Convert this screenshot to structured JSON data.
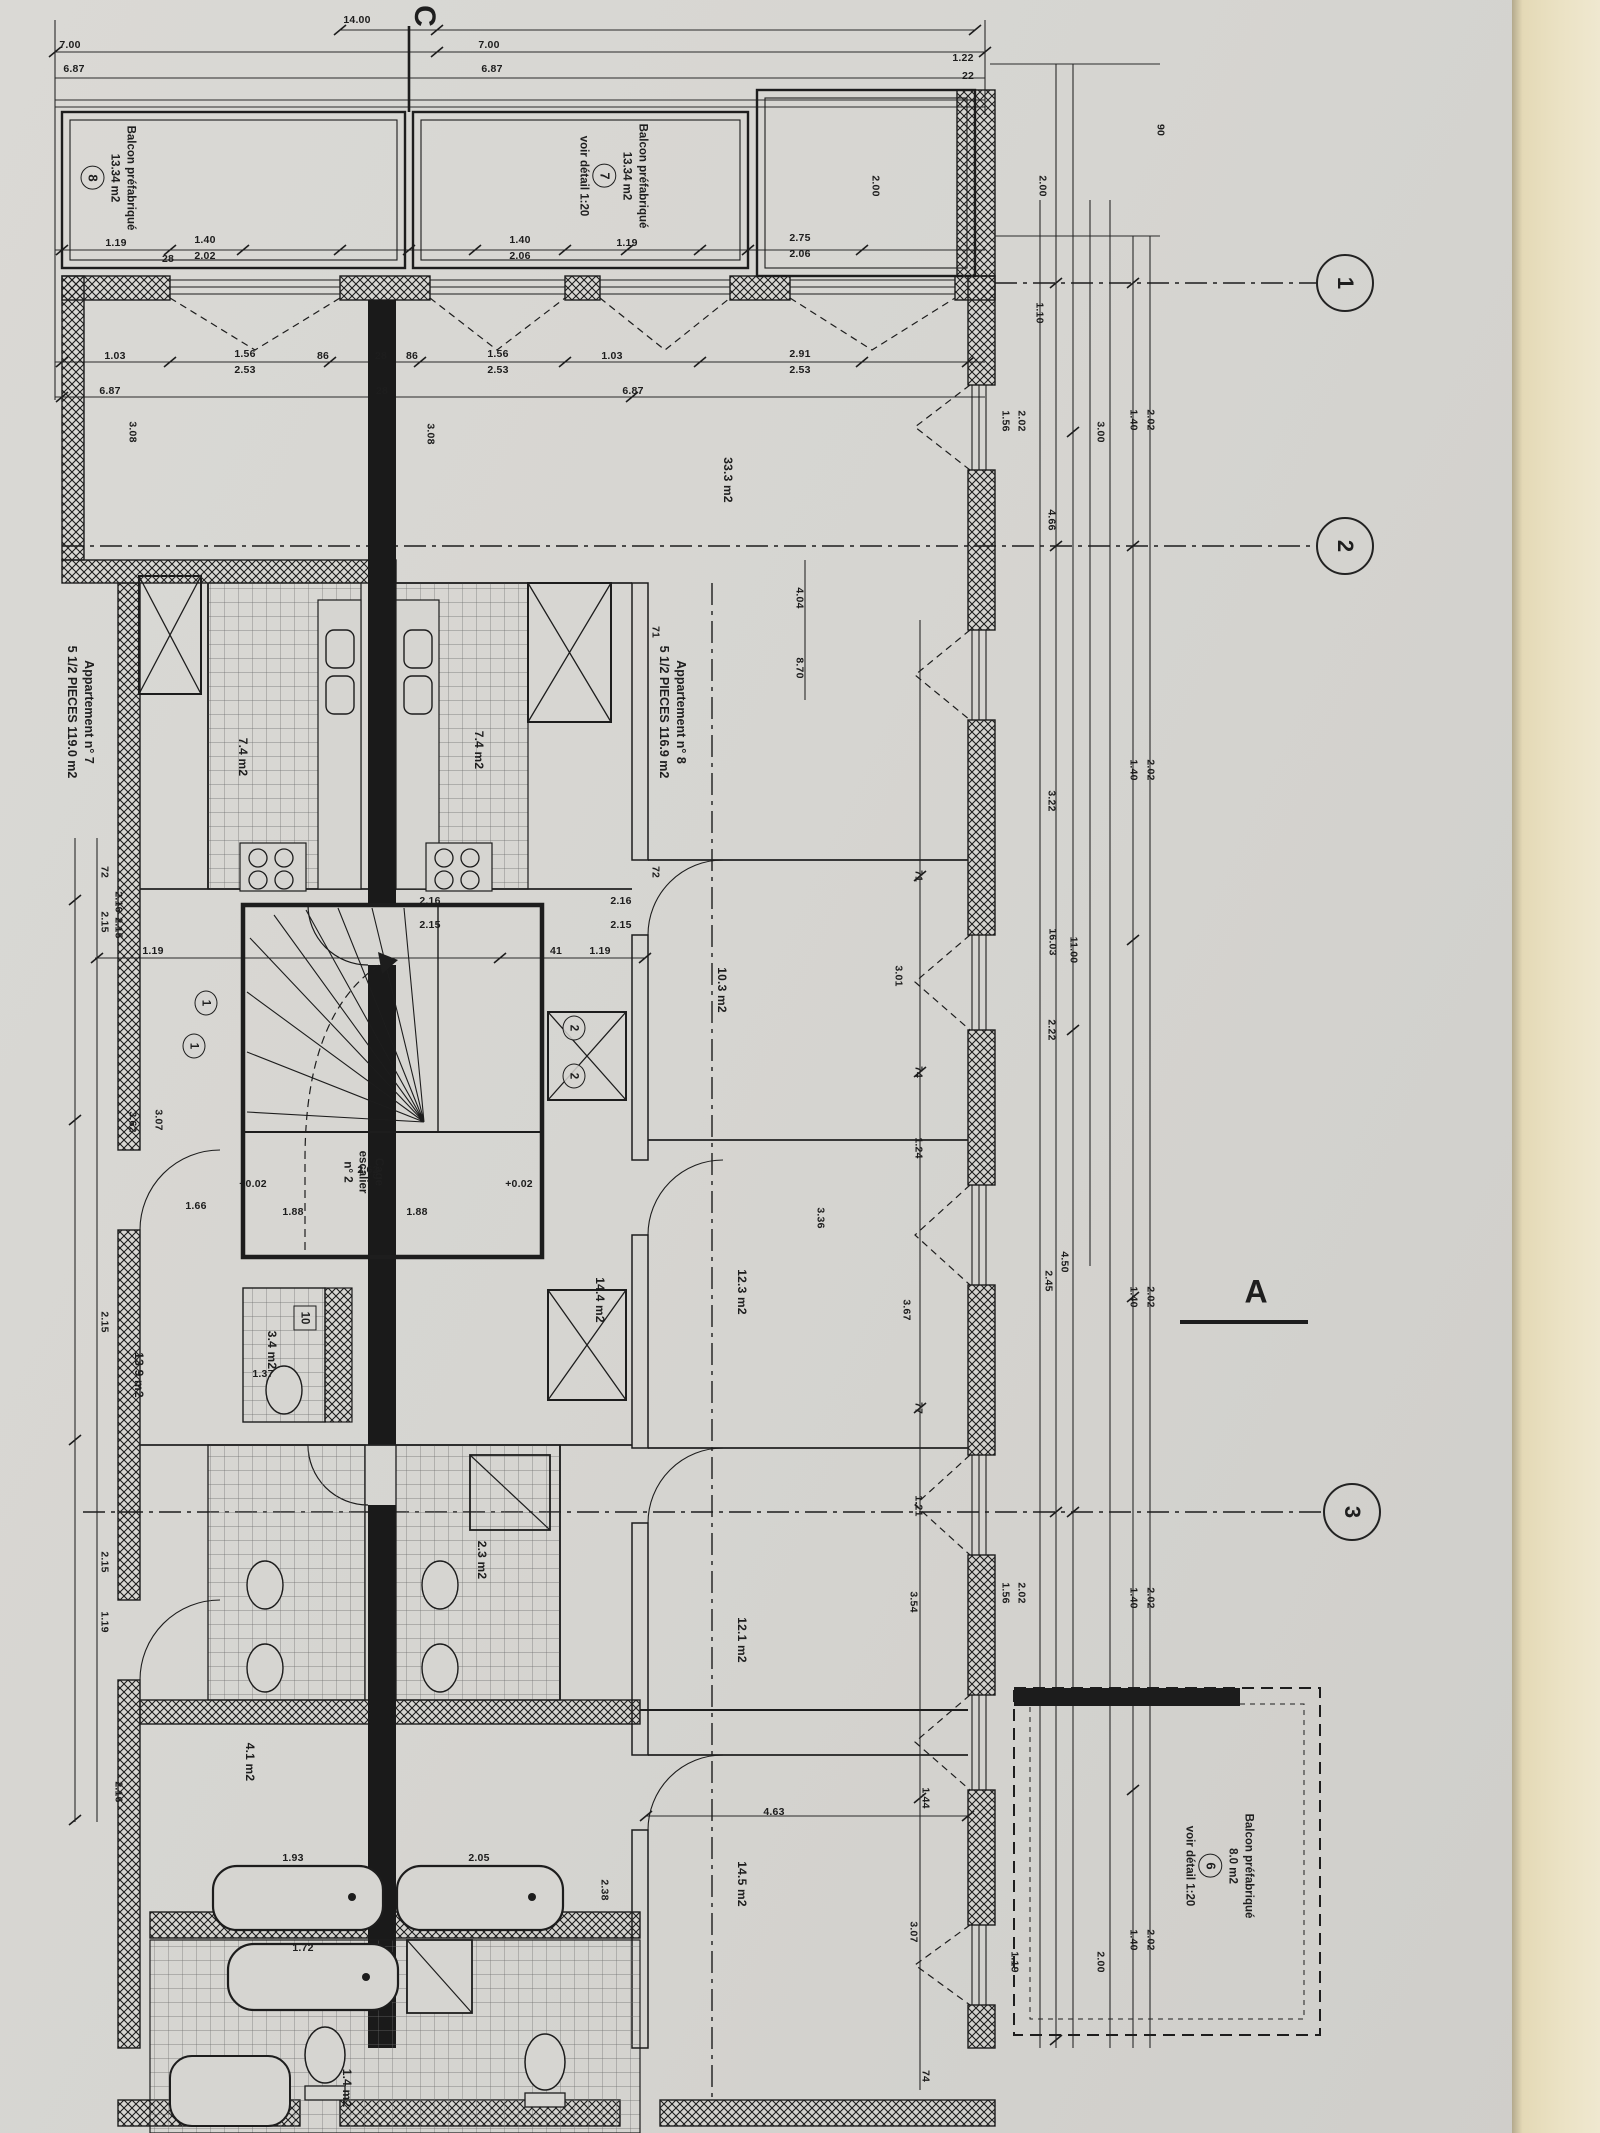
{
  "colors": {
    "paper": "#d6d5d1",
    "ink": "#1e1e1e",
    "cream_strip": "#ebe2c4"
  },
  "grid": {
    "c": "C",
    "section_a": "A",
    "bubbles": [
      "1",
      "2",
      "3"
    ]
  },
  "apartments": [
    {
      "line1": "Appartement n° 7",
      "line2": "5 1/2 PIECES 119.0 m2"
    },
    {
      "line1": "Appartement n° 8",
      "line2": "5 1/2 PIECES 116.9 m2"
    }
  ],
  "balconies": [
    {
      "name": "Balcon préfabriqué",
      "area": "13.34 m2",
      "ref": "8",
      "note": ""
    },
    {
      "name": "Balcon préfabriqué",
      "area": "13.34 m2",
      "ref": "7",
      "note": "voir détail 1:20"
    },
    {
      "name": "Balcon préfabriqué",
      "area": "8.0 m2",
      "ref": "6",
      "note": "voir détail 1:20"
    }
  ],
  "stair": {
    "line1": "Cage",
    "line2": "escalier",
    "line3": "n° 2"
  },
  "rooms": [
    {
      "t": "33.3 m2",
      "x": 728,
      "y": 480
    },
    {
      "t": "10.3 m2",
      "x": 722,
      "y": 990
    },
    {
      "t": "12.3 m2",
      "x": 742,
      "y": 1292
    },
    {
      "t": "12.1 m2",
      "x": 742,
      "y": 1640
    },
    {
      "t": "14.5 m2",
      "x": 742,
      "y": 1884
    },
    {
      "t": "7.4 m2",
      "x": 243,
      "y": 757
    },
    {
      "t": "7.4 m2",
      "x": 479,
      "y": 750
    },
    {
      "t": "3.4 m2",
      "x": 272,
      "y": 1350
    },
    {
      "t": "14.4 m2",
      "x": 600,
      "y": 1300
    },
    {
      "t": "13.9 m2",
      "x": 139,
      "y": 1375
    },
    {
      "t": "4.1 m2",
      "x": 250,
      "y": 1762
    },
    {
      "t": "2.3 m2",
      "x": 482,
      "y": 1560
    },
    {
      "t": "1.4 m2",
      "x": 347,
      "y": 2088
    }
  ],
  "tags": [
    {
      "t": "10",
      "x": 305,
      "y": 1318,
      "shape": "box"
    },
    {
      "t": "1",
      "x": 206,
      "y": 1003,
      "shape": "circle"
    },
    {
      "t": "1",
      "x": 194,
      "y": 1046,
      "shape": "circle"
    },
    {
      "t": "2",
      "x": 574,
      "y": 1028,
      "shape": "circle"
    },
    {
      "t": "2",
      "x": 574,
      "y": 1076,
      "shape": "circle"
    }
  ],
  "dims": [
    {
      "t": "14.00",
      "x": 357,
      "y": 20
    },
    {
      "t": "7.00",
      "x": 70,
      "y": 45
    },
    {
      "t": "6.87",
      "x": 74,
      "y": 69
    },
    {
      "t": "7.00",
      "x": 489,
      "y": 45
    },
    {
      "t": "6.87",
      "x": 492,
      "y": 69
    },
    {
      "t": "1.22",
      "x": 963,
      "y": 58
    },
    {
      "t": "22",
      "x": 968,
      "y": 76
    },
    {
      "t": "1.19",
      "x": 116,
      "y": 243
    },
    {
      "t": "1.40",
      "x": 205,
      "y": 240
    },
    {
      "t": "2.02",
      "x": 205,
      "y": 256
    },
    {
      "t": "1.40",
      "x": 520,
      "y": 240
    },
    {
      "t": "2.06",
      "x": 520,
      "y": 256
    },
    {
      "t": "1.19",
      "x": 627,
      "y": 243
    },
    {
      "t": "2.75",
      "x": 800,
      "y": 238
    },
    {
      "t": "2.06",
      "x": 800,
      "y": 254
    },
    {
      "t": "28",
      "x": 168,
      "y": 259
    },
    {
      "t": "1.03",
      "x": 115,
      "y": 356
    },
    {
      "t": "1.56",
      "x": 245,
      "y": 354
    },
    {
      "t": "2.53",
      "x": 245,
      "y": 370
    },
    {
      "t": "86",
      "x": 323,
      "y": 356
    },
    {
      "t": "28",
      "x": 381,
      "y": 356
    },
    {
      "t": "86",
      "x": 412,
      "y": 356
    },
    {
      "t": "1.56",
      "x": 498,
      "y": 354
    },
    {
      "t": "2.53",
      "x": 498,
      "y": 370
    },
    {
      "t": "1.03",
      "x": 612,
      "y": 356
    },
    {
      "t": "2.91",
      "x": 800,
      "y": 354
    },
    {
      "t": "2.53",
      "x": 800,
      "y": 370
    },
    {
      "t": "6.87",
      "x": 110,
      "y": 391
    },
    {
      "t": "28",
      "x": 382,
      "y": 391
    },
    {
      "t": "6.87",
      "x": 633,
      "y": 391
    },
    {
      "t": "1.19",
      "x": 153,
      "y": 951
    },
    {
      "t": "41",
      "x": 556,
      "y": 951
    },
    {
      "t": "1.19",
      "x": 600,
      "y": 951
    },
    {
      "t": "2.16",
      "x": 621,
      "y": 901
    },
    {
      "t": "2.15",
      "x": 621,
      "y": 925
    },
    {
      "t": "2.16",
      "x": 430,
      "y": 901
    },
    {
      "t": "2.15",
      "x": 430,
      "y": 925
    },
    {
      "t": "2.62",
      "x": 368,
      "y": 1170
    },
    {
      "t": "1.88",
      "x": 417,
      "y": 1212
    },
    {
      "t": "1.88",
      "x": 293,
      "y": 1212
    },
    {
      "t": "+0.02",
      "x": 253,
      "y": 1184
    },
    {
      "t": "+0.02",
      "x": 519,
      "y": 1184
    },
    {
      "t": "1.66",
      "x": 196,
      "y": 1206
    },
    {
      "t": "1.37",
      "x": 263,
      "y": 1374
    },
    {
      "t": "1.93",
      "x": 293,
      "y": 1858
    },
    {
      "t": "2.05",
      "x": 479,
      "y": 1858
    },
    {
      "t": "1.72",
      "x": 303,
      "y": 1948
    },
    {
      "t": "4.63",
      "x": 774,
      "y": 1812
    },
    {
      "t": "2.00",
      "x": 875,
      "y": 186,
      "r": 1
    },
    {
      "t": "2.00",
      "x": 1042,
      "y": 186,
      "r": 1
    },
    {
      "t": "90",
      "x": 1160,
      "y": 130,
      "r": 1
    },
    {
      "t": "1.10",
      "x": 1039,
      "y": 313,
      "r": 1
    },
    {
      "t": "3.00",
      "x": 1100,
      "y": 432,
      "r": 1
    },
    {
      "t": "3.08",
      "x": 132,
      "y": 432,
      "r": 1
    },
    {
      "t": "3.08",
      "x": 430,
      "y": 434,
      "r": 1
    },
    {
      "t": "4.04",
      "x": 799,
      "y": 598,
      "r": 1
    },
    {
      "t": "8.70",
      "x": 799,
      "y": 668,
      "r": 1
    },
    {
      "t": "4.66",
      "x": 1051,
      "y": 520,
      "r": 1
    },
    {
      "t": "16.03",
      "x": 1052,
      "y": 942,
      "r": 1
    },
    {
      "t": "11.00",
      "x": 1073,
      "y": 950,
      "r": 1
    },
    {
      "t": "71",
      "x": 655,
      "y": 632,
      "r": 1
    },
    {
      "t": "72",
      "x": 655,
      "y": 872,
      "r": 1
    },
    {
      "t": "71",
      "x": 918,
      "y": 876,
      "r": 1
    },
    {
      "t": "3.01",
      "x": 898,
      "y": 976,
      "r": 1
    },
    {
      "t": "74",
      "x": 918,
      "y": 1072,
      "r": 1
    },
    {
      "t": "1.24",
      "x": 918,
      "y": 1148,
      "r": 1
    },
    {
      "t": "3.22",
      "x": 1051,
      "y": 801,
      "r": 1
    },
    {
      "t": "2.22",
      "x": 1051,
      "y": 1030,
      "r": 1
    },
    {
      "t": "3.36",
      "x": 820,
      "y": 1218,
      "r": 1
    },
    {
      "t": "3.62",
      "x": 132,
      "y": 1122,
      "r": 1
    },
    {
      "t": "3.07",
      "x": 158,
      "y": 1120,
      "r": 1
    },
    {
      "t": "72",
      "x": 104,
      "y": 872,
      "r": 1
    },
    {
      "t": "2.15",
      "x": 104,
      "y": 922,
      "r": 1
    },
    {
      "t": "2.16",
      "x": 118,
      "y": 902,
      "r": 1
    },
    {
      "t": "2.15",
      "x": 118,
      "y": 928,
      "r": 1
    },
    {
      "t": "3.67",
      "x": 906,
      "y": 1310,
      "r": 1
    },
    {
      "t": "77",
      "x": 918,
      "y": 1408,
      "r": 1
    },
    {
      "t": "1.21",
      "x": 918,
      "y": 1506,
      "r": 1
    },
    {
      "t": "3.54",
      "x": 913,
      "y": 1602,
      "r": 1
    },
    {
      "t": "1.44",
      "x": 925,
      "y": 1798,
      "r": 1
    },
    {
      "t": "2.45",
      "x": 1048,
      "y": 1281,
      "r": 1
    },
    {
      "t": "4.50",
      "x": 1064,
      "y": 1262,
      "r": 1
    },
    {
      "t": "1.40",
      "x": 1133,
      "y": 420,
      "r": 1
    },
    {
      "t": "2.02",
      "x": 1150,
      "y": 420,
      "r": 1
    },
    {
      "t": "1.40",
      "x": 1133,
      "y": 770,
      "r": 1
    },
    {
      "t": "2.02",
      "x": 1150,
      "y": 770,
      "r": 1
    },
    {
      "t": "1.40",
      "x": 1133,
      "y": 1297,
      "r": 1
    },
    {
      "t": "2.02",
      "x": 1150,
      "y": 1297,
      "r": 1
    },
    {
      "t": "1.40",
      "x": 1133,
      "y": 1598,
      "r": 1
    },
    {
      "t": "2.02",
      "x": 1150,
      "y": 1598,
      "r": 1
    },
    {
      "t": "1.40",
      "x": 1133,
      "y": 1940,
      "r": 1
    },
    {
      "t": "2.02",
      "x": 1150,
      "y": 1940,
      "r": 1
    },
    {
      "t": "1.56",
      "x": 1005,
      "y": 421,
      "r": 1
    },
    {
      "t": "2.02",
      "x": 1021,
      "y": 421,
      "r": 1
    },
    {
      "t": "1.56",
      "x": 1005,
      "y": 1593,
      "r": 1
    },
    {
      "t": "2.02",
      "x": 1021,
      "y": 1593,
      "r": 1
    },
    {
      "t": "2.15",
      "x": 104,
      "y": 1322,
      "r": 1
    },
    {
      "t": "2.15",
      "x": 104,
      "y": 1562,
      "r": 1
    },
    {
      "t": "1.19",
      "x": 104,
      "y": 1622,
      "r": 1
    },
    {
      "t": "2.16",
      "x": 118,
      "y": 1792,
      "r": 1
    },
    {
      "t": "2.38",
      "x": 604,
      "y": 1890,
      "r": 1
    },
    {
      "t": "3.07",
      "x": 913,
      "y": 1932,
      "r": 1
    },
    {
      "t": "74",
      "x": 925,
      "y": 2076,
      "r": 1
    },
    {
      "t": "1.19",
      "x": 1014,
      "y": 1962,
      "r": 1
    },
    {
      "t": "2.00",
      "x": 1100,
      "y": 1962,
      "r": 1
    }
  ]
}
